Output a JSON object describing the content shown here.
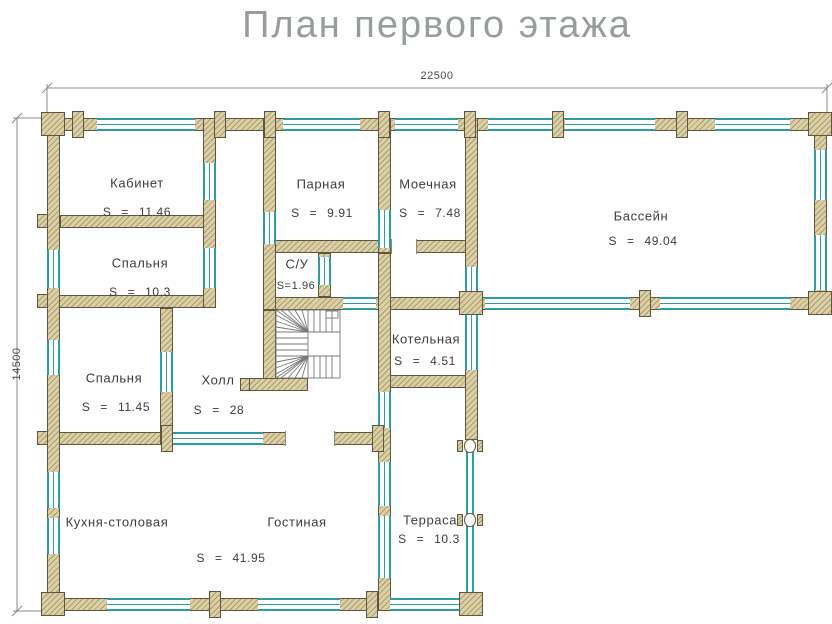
{
  "title": "План первого этажа",
  "dimensions": {
    "width_label": "22500",
    "height_label": "14500"
  },
  "rooms": [
    {
      "name": "Кабинет",
      "area": "S = 11.46"
    },
    {
      "name": "Спальня",
      "area": "S = 10.3"
    },
    {
      "name": "Парная",
      "area": "S = 9.91"
    },
    {
      "name": "Моечная",
      "area": "S = 7.48"
    },
    {
      "name": "С/У",
      "area": "S=1.96"
    },
    {
      "name": "Бассейн",
      "area": "S = 49.04"
    },
    {
      "name": "Котельная",
      "area": "S = 4.51"
    },
    {
      "name": "Спальня",
      "area": "S = 11.45"
    },
    {
      "name": "Холл",
      "area": "S = 28"
    },
    {
      "name": "Кухня-столовая",
      "area": ""
    },
    {
      "name": "Гостиная",
      "area": "S = 41.95"
    },
    {
      "name": "Терраса",
      "area": "S = 10.3"
    }
  ],
  "colors": {
    "wall_fill": "#dcd0a7",
    "wall_outline": "#5c563e",
    "window_teal": "#2b9ea4",
    "title_text": "#979c9c",
    "label_text": "#3d3d3d"
  }
}
